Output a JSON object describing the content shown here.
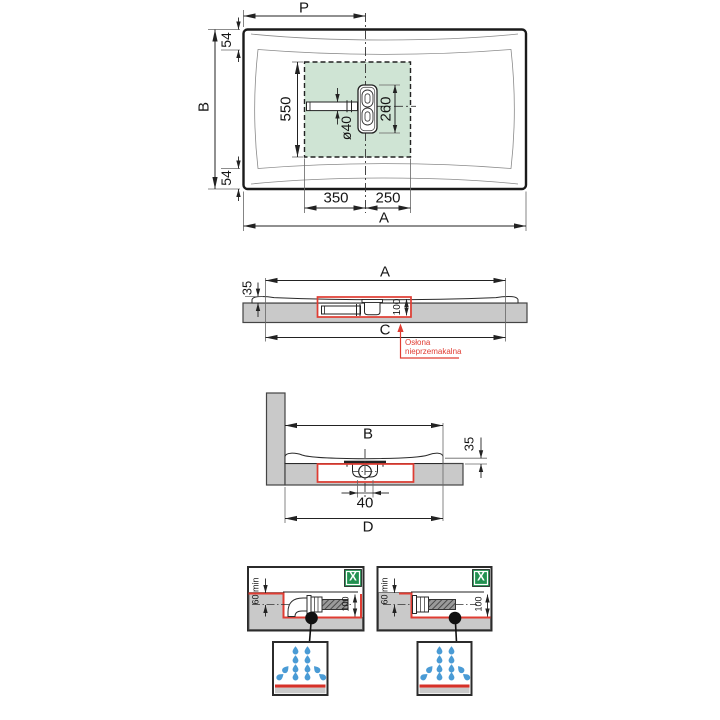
{
  "drawing": {
    "top_view": {
      "p": "P",
      "b": "B",
      "edge_top": "54",
      "edge_bottom": "54",
      "drain_zone_height": "550",
      "pipe_diameter": "ø40",
      "drain_length": "260",
      "offset_left": "350",
      "offset_right": "250",
      "a": "A"
    },
    "side_view": {
      "a": "A",
      "tray_height": "35",
      "recess_depth": "100",
      "c": "C",
      "note_line1": "Osłona",
      "note_line2": "nieprzemakalna"
    },
    "section_view": {
      "b": "B",
      "tray_height": "35",
      "pipe_width": "40",
      "d": "D"
    },
    "details": {
      "left": {
        "floor_clearance": "60 min",
        "recess_depth": "100",
        "marker": "X"
      },
      "right": {
        "floor_clearance": "60 min",
        "recess_depth": "100",
        "marker": "X"
      }
    },
    "colors": {
      "annotation_red": "#e03c32",
      "drain_zone_green": "#cfe4d4",
      "marker_green": "#219150",
      "water_blue": "#4a9bd5",
      "floor_gray": "#c9c9c9"
    }
  }
}
